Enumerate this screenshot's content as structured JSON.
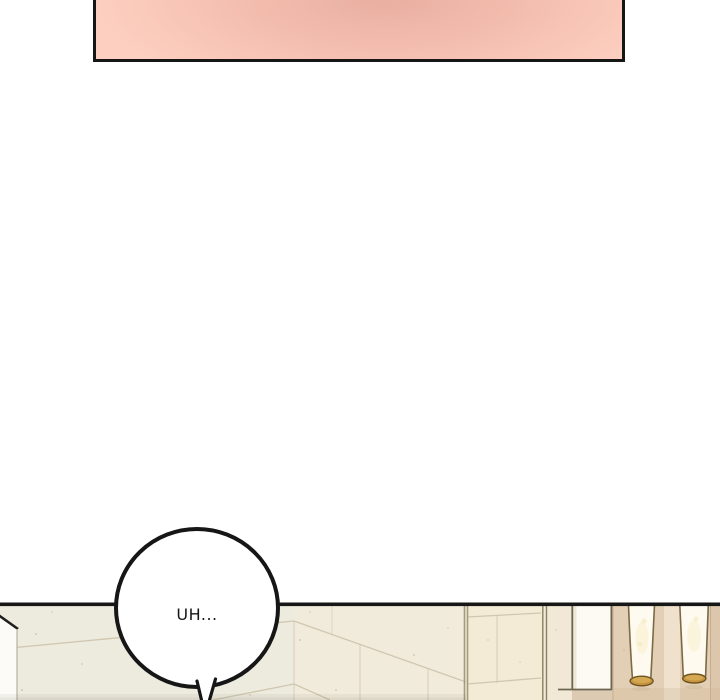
{
  "speech_bubble": {
    "text": "UH..."
  },
  "colors": {
    "ink": "#161616",
    "pink_dark": "#e9afa1",
    "pink_mid": "#f2bcad",
    "pink_light": "#fac9ba",
    "pink_lighter": "#fccfc0",
    "wall_left": "#edeade",
    "wall_mid": "#f1ebdc",
    "wall_right_face": "#f4ebd7",
    "wall_strip": "#f1e9d5",
    "wall_tan": "#e3cfb5",
    "wall_tan_light": "#efe1cc",
    "wall_tan_dark": "#dcc7ac",
    "grout": "#cfc7b0",
    "trim_dark": "#6e6550",
    "pillar_white": "#fcfaf3",
    "door_white": "#fcfbf7",
    "lamp_shade": "#fefaf0",
    "lamp_glow": "#f8eec9",
    "lamp_rim_gold": "#c79440",
    "lamp_rim_edge": "#6d5320",
    "lamp_outline": "#7a6a45",
    "bubble_fill": "#ffffff"
  }
}
